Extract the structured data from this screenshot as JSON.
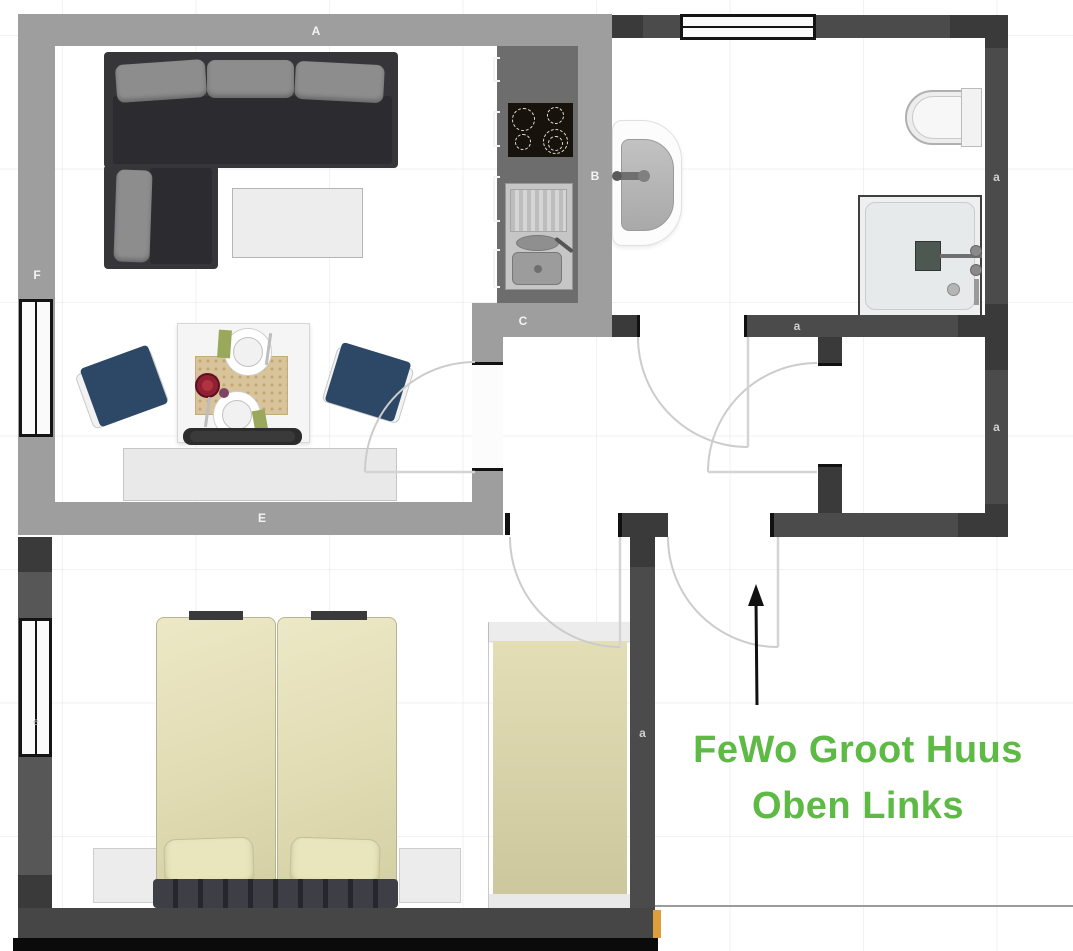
{
  "plan": {
    "annotation": {
      "line1": "FeWo Groot Huus",
      "line2": "Oben Links"
    },
    "wall_labels": {
      "top_wall": "A",
      "left_wall": "F",
      "living_bottom_wall": "E",
      "kitchen_wall": "B",
      "kitchen_bottom_wall": "C",
      "bath_bottom_wall": "a",
      "bath_right_wall": "a",
      "room_right_wall": "a",
      "bedroom_divider_wall": "a",
      "bedroom_window": "e"
    },
    "colors": {
      "light_walls": "#9e9e9e",
      "dark_walls": "#4b4b4b",
      "annotation_green": "#5cba45",
      "entry_marker_amber": "#dd9f3c",
      "chair_navy": "#2c4866",
      "bed_cream": "#e7e3ba"
    }
  }
}
